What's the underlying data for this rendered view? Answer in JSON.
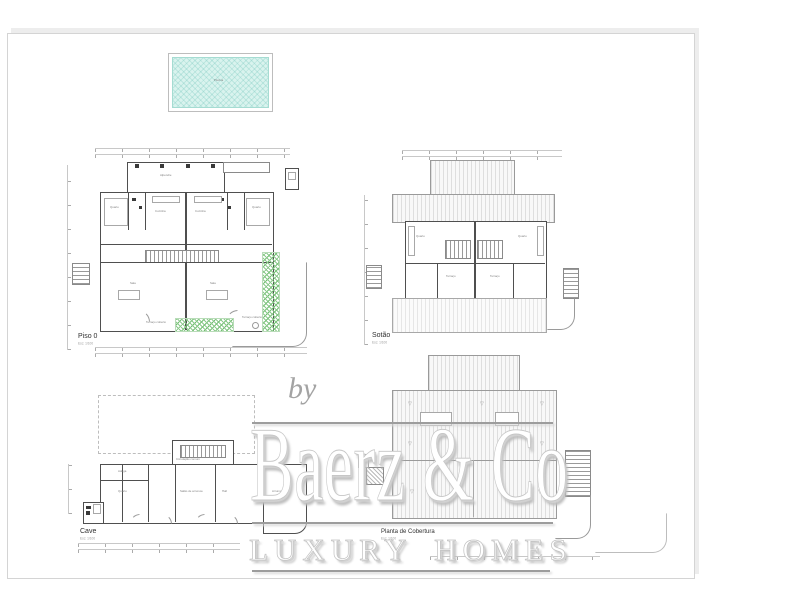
{
  "watermark": {
    "by_label": "by",
    "brand": "Baerz & Co",
    "tagline": "LUXURY HOMES"
  },
  "pool": {
    "label": "Piscina"
  },
  "plans": {
    "piso0": {
      "title": "Piso 0",
      "subtitle": "Esc: 1/100",
      "rooms": [
        "Alpendre",
        "Quarto",
        "Cozinha",
        "Cozinha",
        "Quarto",
        "Sala",
        "Sala",
        "Terraço coberto",
        "Terraço coberto"
      ]
    },
    "sotao": {
      "title": "Sotão",
      "subtitle": "Esc: 1/100",
      "rooms": [
        "Quarto",
        "Quarto",
        "Terraço",
        "Terraço"
      ]
    },
    "cave": {
      "title": "Cave",
      "subtitle": "Esc: 1/100",
      "rooms": [
        "Circulação comum",
        "Adega",
        "Quarto",
        "Salão de arrumos",
        "Hall",
        "Arrumos"
      ]
    },
    "cobertura": {
      "title": "Planta de Cobertura",
      "subtitle": "Esc: 1/100",
      "slope_marker": "▽"
    }
  },
  "colors": {
    "pool_fill": "#d9f3ee",
    "vegetation_green": "#7cc47c",
    "roof_stripe_gray": "#e2e2e2",
    "wall_gray": "#4f4f4f",
    "watermark_gray": "#9d9d9d"
  }
}
